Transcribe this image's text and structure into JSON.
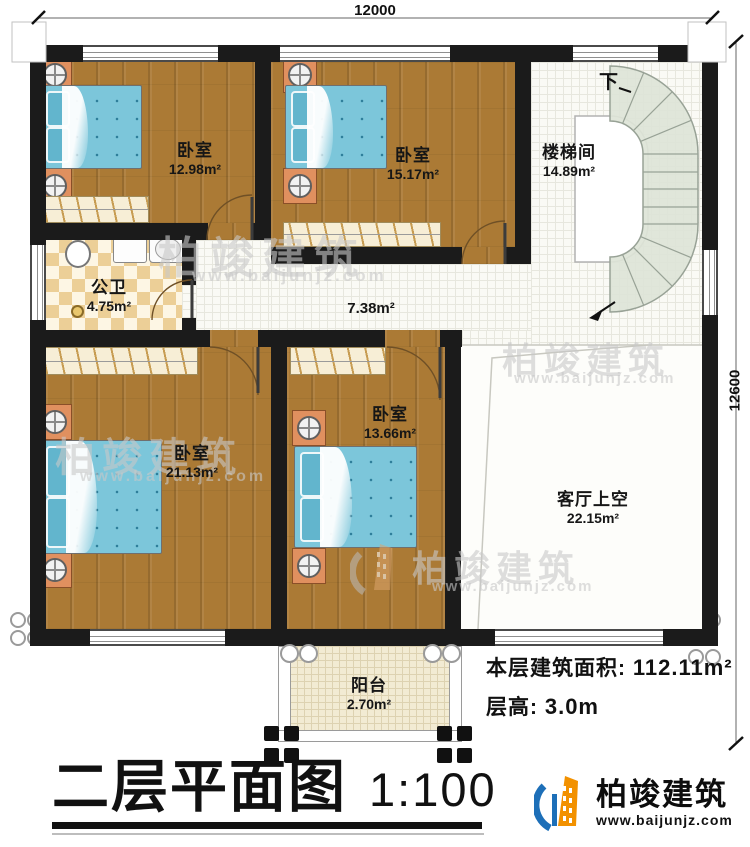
{
  "meta": {
    "title": "二层平面图",
    "scale": "1:100"
  },
  "logo": {
    "name": "柏竣建筑",
    "url": "www.baijunjz.com"
  },
  "watermark": {
    "name": "柏竣建筑",
    "url": "www.baijunjz.com"
  },
  "dimensions": {
    "top": "12000",
    "right": "12600"
  },
  "info": {
    "area_label": "本层建筑面积:",
    "area_value": "112.11m²",
    "height_label": "层高:",
    "height_value": "3.0m"
  },
  "stairs": {
    "down_label": "下"
  },
  "rooms": [
    {
      "id": "bedroom-top-left",
      "name": "卧室",
      "area": "12.98m²"
    },
    {
      "id": "bedroom-top-middle",
      "name": "卧室",
      "area": "15.17m²"
    },
    {
      "id": "stairwell",
      "name": "楼梯间",
      "area": "14.89m²"
    },
    {
      "id": "bathroom",
      "name": "公卫",
      "area": "4.75m²"
    },
    {
      "id": "corridor",
      "name": "",
      "area": "7.38m²"
    },
    {
      "id": "bedroom-bottom-left",
      "name": "卧室",
      "area": "21.13m²"
    },
    {
      "id": "bedroom-bottom-mid",
      "name": "卧室",
      "area": "13.66m²"
    },
    {
      "id": "living-room-void",
      "name": "客厅上空",
      "area": "22.15m²"
    },
    {
      "id": "balcony",
      "name": "阳台",
      "area": "2.70m²"
    }
  ]
}
